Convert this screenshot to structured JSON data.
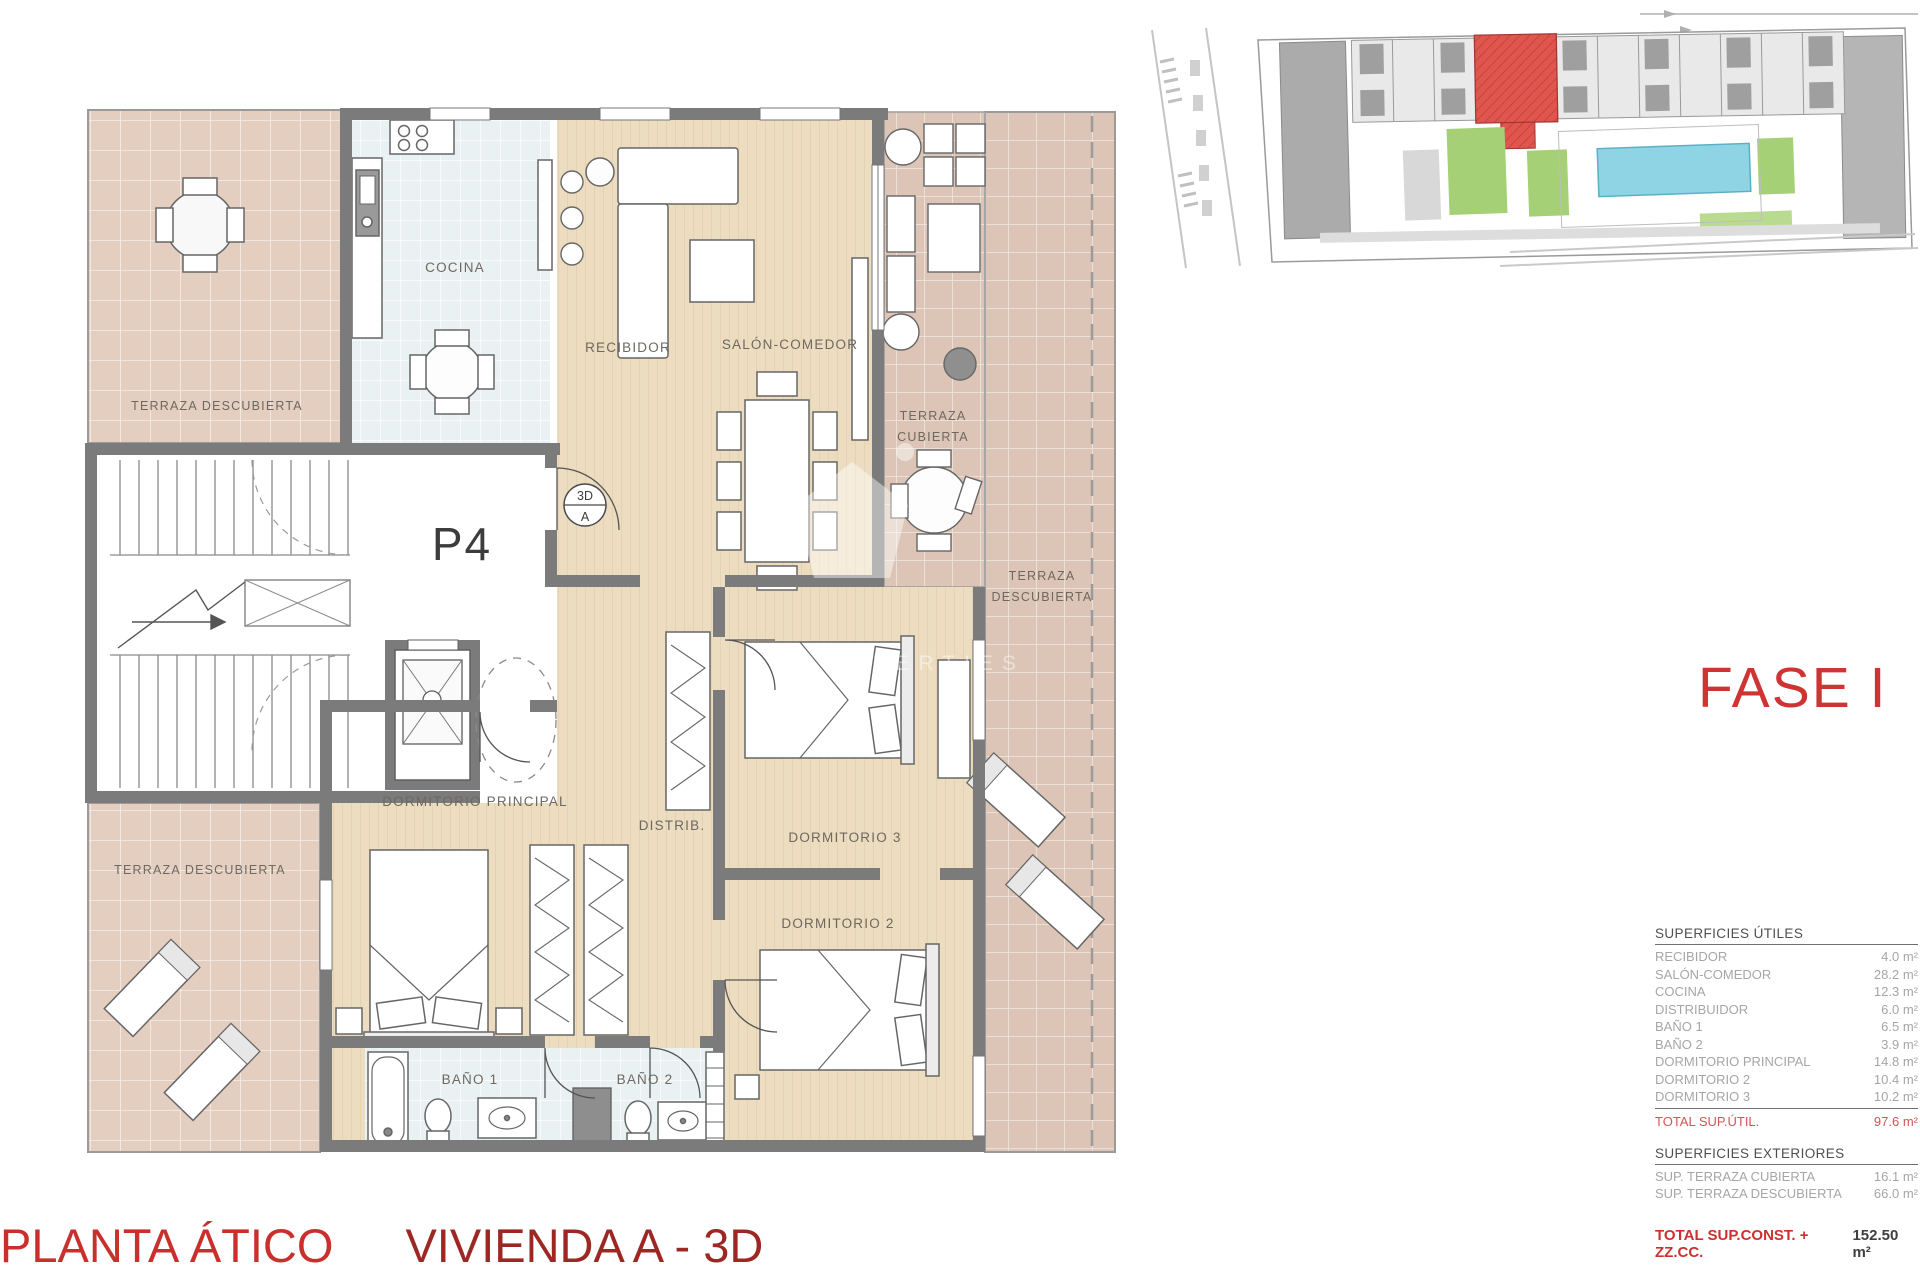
{
  "titles": {
    "fase": "FASE I",
    "plano_left": "PLANTA ÁTICO",
    "plano_right": "VIVIENDA A - 3D"
  },
  "floorplan": {
    "unit": "P4",
    "marker_top": "3D",
    "marker_bottom": "A",
    "watermark": "PROPERTIES",
    "labels": {
      "terraza_tl": "TERRAZA DESCUBIERTA",
      "cocina": "COCINA",
      "recibidor": "RECIBIDOR",
      "salon": "SALÓN-COMEDOR",
      "terraza_cubierta_1": "TERRAZA",
      "terraza_cubierta_2": "CUBIERTA",
      "terraza_right_1": "TERRAZA",
      "terraza_right_2": "DESCUBIERTA",
      "terraza_bl": "TERRAZA DESCUBIERTA",
      "dormitorio_principal": "DORMITORIO PRINCIPAL",
      "distrib": "DISTRIB.",
      "dormitorio_3": "DORMITORIO 3",
      "dormitorio_2": "DORMITORIO 2",
      "bano_1": "BAÑO 1",
      "bano_2": "BAÑO 2"
    }
  },
  "tables": {
    "utiles": {
      "header": "SUPERFICIES ÚTILES",
      "rows": [
        {
          "label": "RECIBIDOR",
          "value": "4.0 m²"
        },
        {
          "label": "SALÓN-COMEDOR",
          "value": "28.2 m²"
        },
        {
          "label": "COCINA",
          "value": "12.3 m²"
        },
        {
          "label": "DISTRIBUIDOR",
          "value": "6.0 m²"
        },
        {
          "label": "BAÑO 1",
          "value": "6.5 m²"
        },
        {
          "label": "BAÑO 2",
          "value": "3.9 m²"
        },
        {
          "label": "DORMITORIO PRINCIPAL",
          "value": "14.8 m²"
        },
        {
          "label": "DORMITORIO 2",
          "value": "10.4 m²"
        },
        {
          "label": "DORMITORIO 3",
          "value": "10.2 m²"
        }
      ],
      "total_label": "TOTAL SUP.ÚTIL.",
      "total_value": "97.6 m²"
    },
    "exteriores": {
      "header": "SUPERFICIES EXTERIORES",
      "rows": [
        {
          "label": "SUP. TERRAZA CUBIERTA",
          "value": "16.1 m²"
        },
        {
          "label": "SUP. TERRAZA DESCUBIERTA",
          "value": "66.0 m²"
        }
      ]
    },
    "total_const": {
      "label": "TOTAL SUP.CONST. + ZZ.CC.",
      "value": "152.50 m²"
    }
  },
  "colors": {
    "wall": "#7b7b7b",
    "accent_red": "#cf3434",
    "title_red_dark": "#9d2823",
    "tile_pink": "#dcc5b6",
    "tile_pink_light": "#e3cec0",
    "tile_blue": "#e9f1f2",
    "wood": "#ecdcc0",
    "site_highlight": "#e0564e",
    "pool_blue": "#8fd4e4",
    "green": "#a5d075"
  }
}
